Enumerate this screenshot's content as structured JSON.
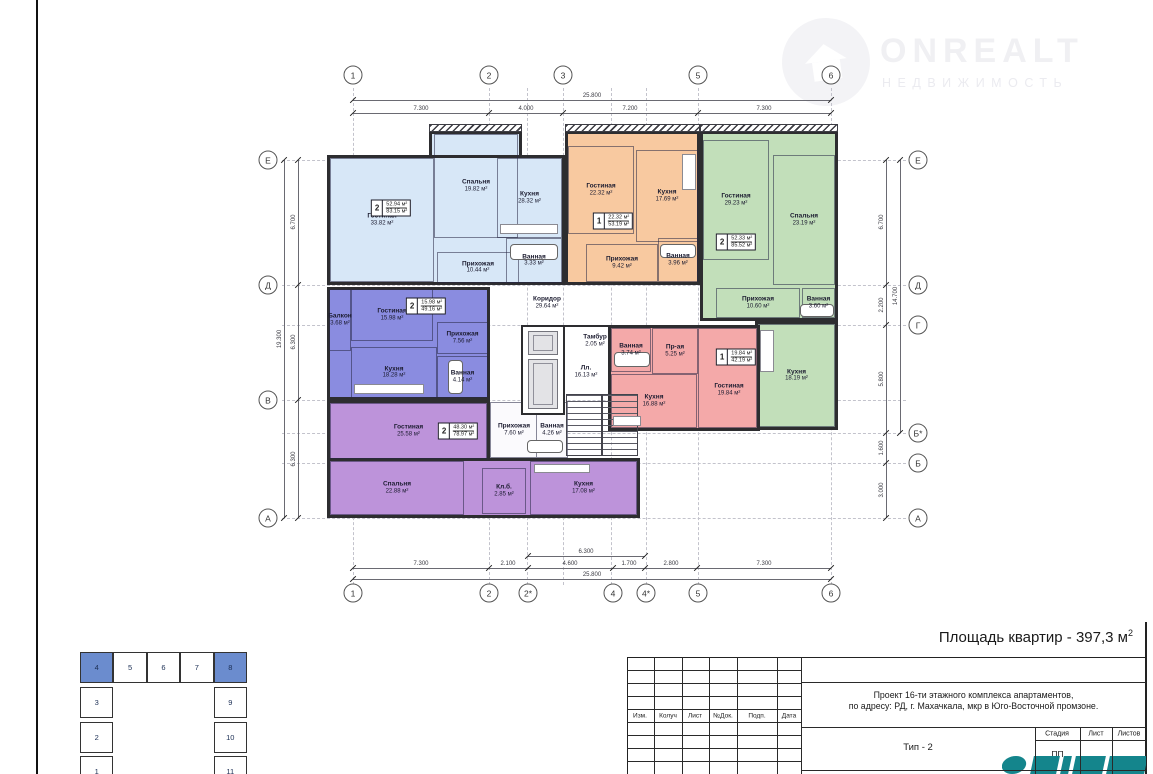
{
  "watermark": {
    "brand": "ONREALT",
    "subtitle": "НЕДВИЖИМОСТЬ"
  },
  "summary": {
    "area_label": "Площадь квартир - 397,3 м",
    "area_sup": "2"
  },
  "axes": {
    "top": [
      "1",
      "2",
      "3",
      "5",
      "6"
    ],
    "bottom": [
      "1",
      "2",
      "2*",
      "4",
      "4*",
      "5",
      "6"
    ],
    "left": [
      "Е",
      "Д",
      "В",
      "А"
    ],
    "right": [
      "Е",
      "Д",
      "Г",
      "Б*",
      "Б",
      "А"
    ]
  },
  "dimensions": {
    "top_total": "25.800",
    "top_segments": [
      "7.300",
      "4.000",
      "7.200",
      "7.300"
    ],
    "bottom_sub": "6.300",
    "bottom_segments": [
      "7.300",
      "2.100",
      "4.600",
      "1.700",
      "2.800",
      "7.300"
    ],
    "bottom_total": "25.800",
    "left_segments": [
      "6.700",
      "6.300",
      "6.300"
    ],
    "left_total": "19.300",
    "right_segments": [
      "6.700",
      "2.200",
      "5.800",
      "1.600",
      "3.000"
    ],
    "right_total": "14.700"
  },
  "apartments": [
    {
      "id": "b1",
      "color": "#d7e7f7",
      "badge": {
        "num": "2",
        "living": "52.94 м²",
        "total": "83.15 м²"
      },
      "rooms": [
        {
          "name": "Гостиная",
          "area": "33.82 м²"
        },
        {
          "name": "Спальня",
          "area": "19.82 м²"
        },
        {
          "name": "Кухня",
          "area": "28.32 м²"
        },
        {
          "name": "Прихожая",
          "area": "10.44 м²"
        },
        {
          "name": "Ванная",
          "area": "3.33 м²"
        }
      ]
    },
    {
      "id": "o1",
      "color": "#f8c9a0",
      "badge": {
        "num": "1",
        "living": "22.32 м²",
        "total": "53.19 м²"
      },
      "rooms": [
        {
          "name": "Гостиная",
          "area": "22.32 м²"
        },
        {
          "name": "Кухня",
          "area": "17.69 м²"
        },
        {
          "name": "Прихожая",
          "area": "9.42 м²"
        },
        {
          "name": "Ванная",
          "area": "3.96 м²"
        }
      ]
    },
    {
      "id": "g1",
      "color": "#c2dfba",
      "badge": {
        "num": "2",
        "living": "52.33 м²",
        "total": "85.52 м²"
      },
      "rooms": [
        {
          "name": "Гостиная",
          "area": "29.23 м²"
        },
        {
          "name": "Спальня",
          "area": "23.19 м²"
        },
        {
          "name": "Прихожая",
          "area": "10.60 м²"
        },
        {
          "name": "Ванная",
          "area": "3.60 м²"
        },
        {
          "name": "Кухня",
          "area": "18.19 м²"
        }
      ]
    },
    {
      "id": "v1",
      "color": "#8a8ce0",
      "badge": {
        "num": "2",
        "living": "15.98 м²",
        "total": "49.16 м²"
      },
      "rooms": [
        {
          "name": "Балкон",
          "area": "3.68 м²"
        },
        {
          "name": "Гостиная",
          "area": "15.98 м²"
        },
        {
          "name": "Прихожая",
          "area": "7.56 м²"
        },
        {
          "name": "Кухня",
          "area": "18.28 м²"
        },
        {
          "name": "Ванная",
          "area": "4.14 м²"
        }
      ]
    },
    {
      "id": "p1",
      "color": "#bd93da",
      "badge": {
        "num": "2",
        "living": "48.30 м²",
        "total": "78.97 м²"
      },
      "rooms": [
        {
          "name": "Гостиная",
          "area": "25.58 м²"
        },
        {
          "name": "Спальня",
          "area": "22.88 м²"
        },
        {
          "name": "Прихожая",
          "area": "7.60 м²"
        },
        {
          "name": "Ванная",
          "area": "4.26 м²"
        },
        {
          "name": "Кл.б.",
          "area": "2.85 м²"
        },
        {
          "name": "Кухня",
          "area": "17.08 м²"
        }
      ]
    },
    {
      "id": "r1",
      "color": "#f4a9a9",
      "badge": {
        "num": "1",
        "living": "19.84 м²",
        "total": "42.19 м²"
      },
      "rooms": [
        {
          "name": "Ванная",
          "area": "3.74 м²"
        },
        {
          "name": "Пр-ая",
          "area": "5.25 м²"
        },
        {
          "name": "Кухня",
          "area": "16.88 м²"
        },
        {
          "name": "Гостиная",
          "area": "19.84 м²"
        }
      ]
    }
  ],
  "common_rooms": [
    {
      "name": "Коридор",
      "area": "29.64 м²"
    },
    {
      "name": "Тамбур",
      "area": "2.05 м²"
    },
    {
      "name": "Лл.",
      "area": "16.13 м²"
    }
  ],
  "title_block": {
    "revision_headers": [
      "Изм.",
      "Колуч",
      "Лист",
      "№Док.",
      "Подп.",
      "Дата"
    ],
    "project_line1": "Проект 16-ти этажного комплекса апартаментов,",
    "project_line2": "по адресу: РД, г. Махачкала, мкр в Юго-Восточной промзоне.",
    "type_label": "Тип - 2",
    "stage_headers": [
      "Стадия",
      "Лист",
      "Листов"
    ],
    "stage_value": "ПП",
    "logo_color": "#14858c"
  },
  "key_plan": {
    "top_row": [
      "4",
      "5",
      "6",
      "7",
      "8"
    ],
    "left_col": [
      "3",
      "2",
      "1"
    ],
    "right_col": [
      "9",
      "10",
      "11"
    ],
    "highlighted": [
      "4",
      "8"
    ],
    "highlight_color": "#6b8cce"
  }
}
